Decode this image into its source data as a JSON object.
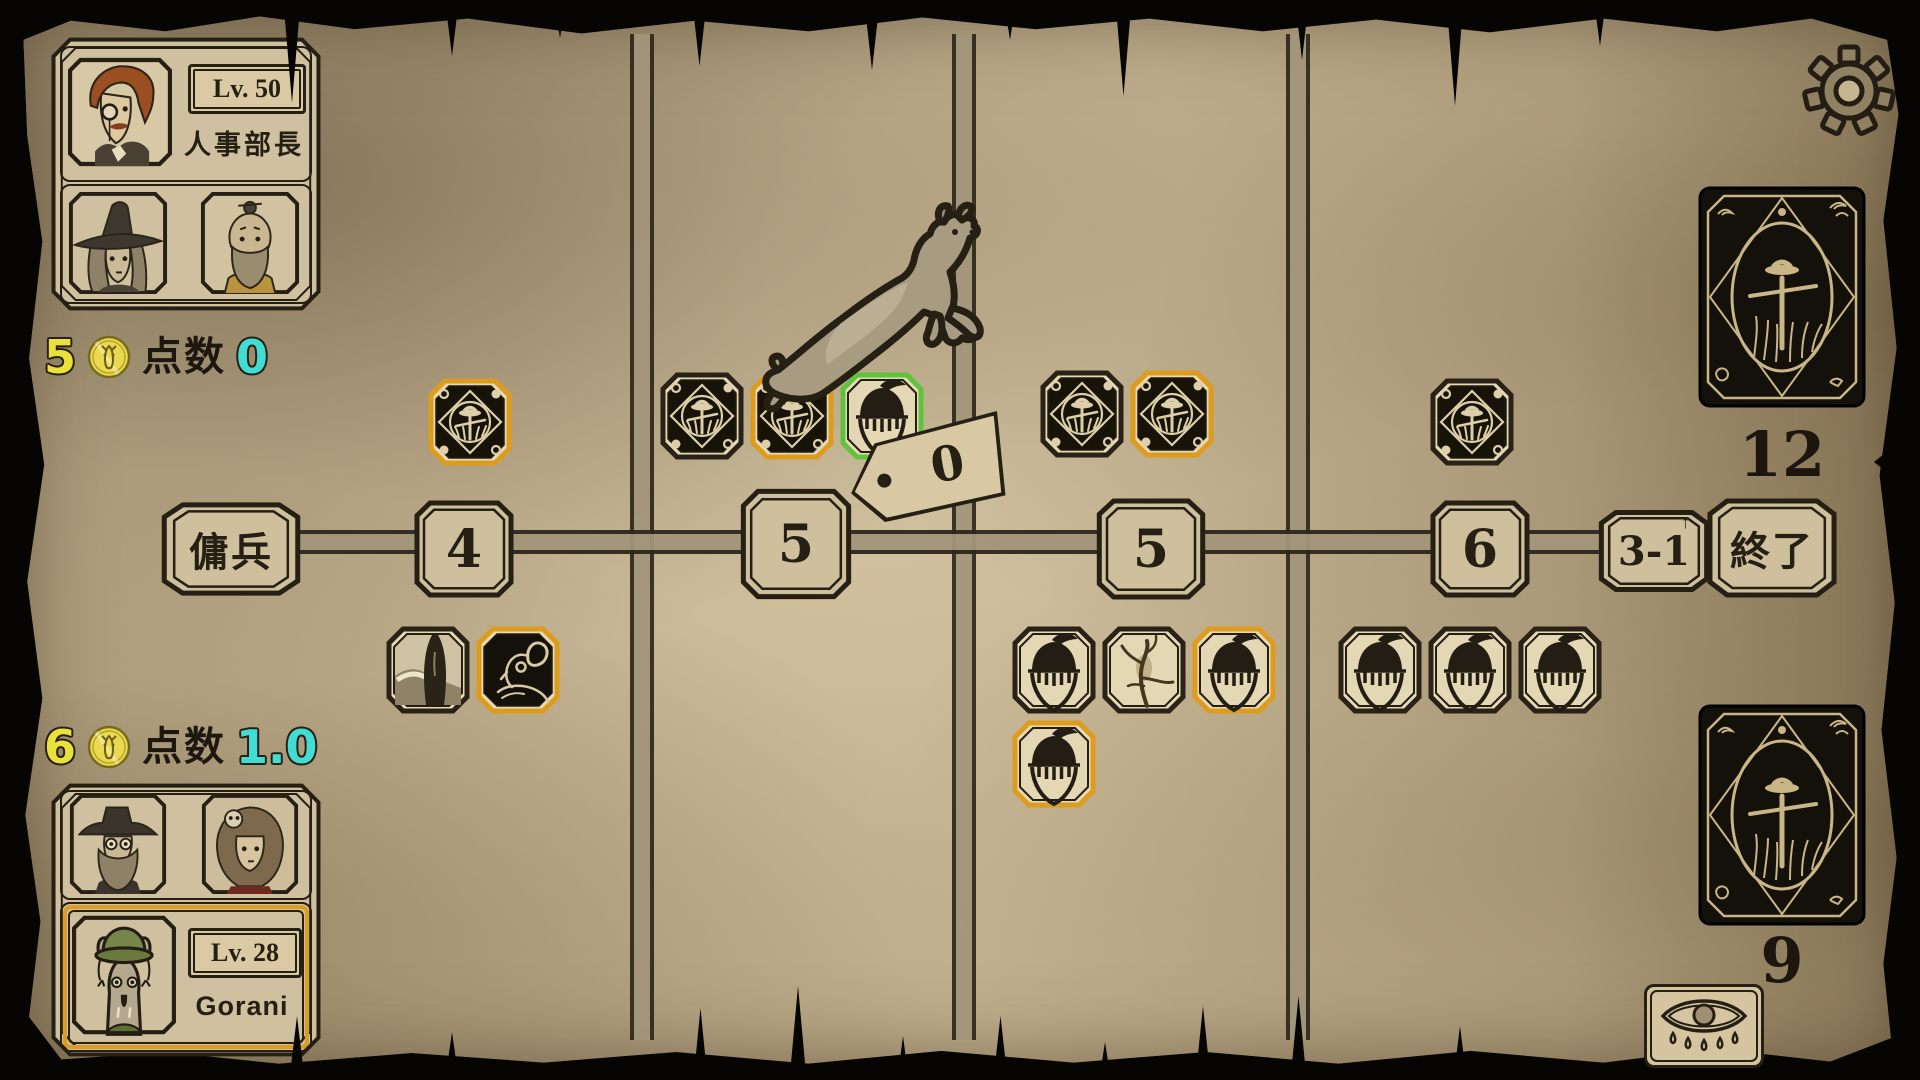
{
  "hud": {
    "opponent": {
      "level": "Lv. 50",
      "title": "人事部長",
      "coins": "5",
      "score_label": "点数",
      "score": "0",
      "portraits": [
        "monocle-man",
        "witch",
        "elder-topknot"
      ]
    },
    "player": {
      "level": "Lv. 28",
      "name": "Gorani",
      "coins": "6",
      "score_label": "点数",
      "score": "1.0",
      "portraits": [
        "hat-beard-man",
        "skull-woman",
        "gorani-deer"
      ]
    }
  },
  "track": {
    "nodes": [
      {
        "id": "mercenary",
        "label": "傭兵"
      },
      {
        "id": "step-4",
        "label": "4"
      },
      {
        "id": "step-5a",
        "label": "5"
      },
      {
        "id": "step-5b",
        "label": "5"
      },
      {
        "id": "step-6",
        "label": "6"
      },
      {
        "id": "step-3-1",
        "label": "3-1",
        "arrow": "↑"
      },
      {
        "id": "end",
        "label": "終了"
      }
    ],
    "price_tag": {
      "value": "0"
    },
    "marker": {
      "type": "goat",
      "at": "step-5a"
    }
  },
  "board": {
    "zones": {
      "above-4": [
        {
          "type": "scarecrow",
          "border": "orange"
        }
      ],
      "above-5a": [
        {
          "type": "scarecrow",
          "border": "plain"
        },
        {
          "type": "scarecrow",
          "border": "orange"
        },
        {
          "type": "acorn-knight",
          "border": "green"
        }
      ],
      "above-5b": [
        {
          "type": "scarecrow",
          "border": "plain"
        },
        {
          "type": "scarecrow",
          "border": "orange"
        }
      ],
      "above-6": [
        {
          "type": "scarecrow",
          "border": "plain"
        }
      ],
      "below-4": [
        {
          "type": "veiled-figure",
          "border": "plain"
        },
        {
          "type": "ram",
          "border": "orange"
        }
      ],
      "below-5b-row1": [
        {
          "type": "acorn-knight",
          "border": "plain"
        },
        {
          "type": "twig",
          "border": "plain"
        },
        {
          "type": "acorn-knight",
          "border": "orange"
        }
      ],
      "below-5b-row2": [
        {
          "type": "acorn-knight",
          "border": "orange"
        }
      ],
      "below-6": [
        {
          "type": "acorn-knight",
          "border": "plain"
        },
        {
          "type": "acorn-knight",
          "border": "plain"
        },
        {
          "type": "acorn-knight",
          "border": "plain"
        }
      ]
    }
  },
  "decks": {
    "draw_count": "12",
    "discard_count": "9"
  },
  "colors": {
    "orange": "#dd9c1d",
    "green": "#5ec43c",
    "yellow": "#eae13a",
    "cyan": "#41ddd5",
    "ink": "#261f14"
  }
}
